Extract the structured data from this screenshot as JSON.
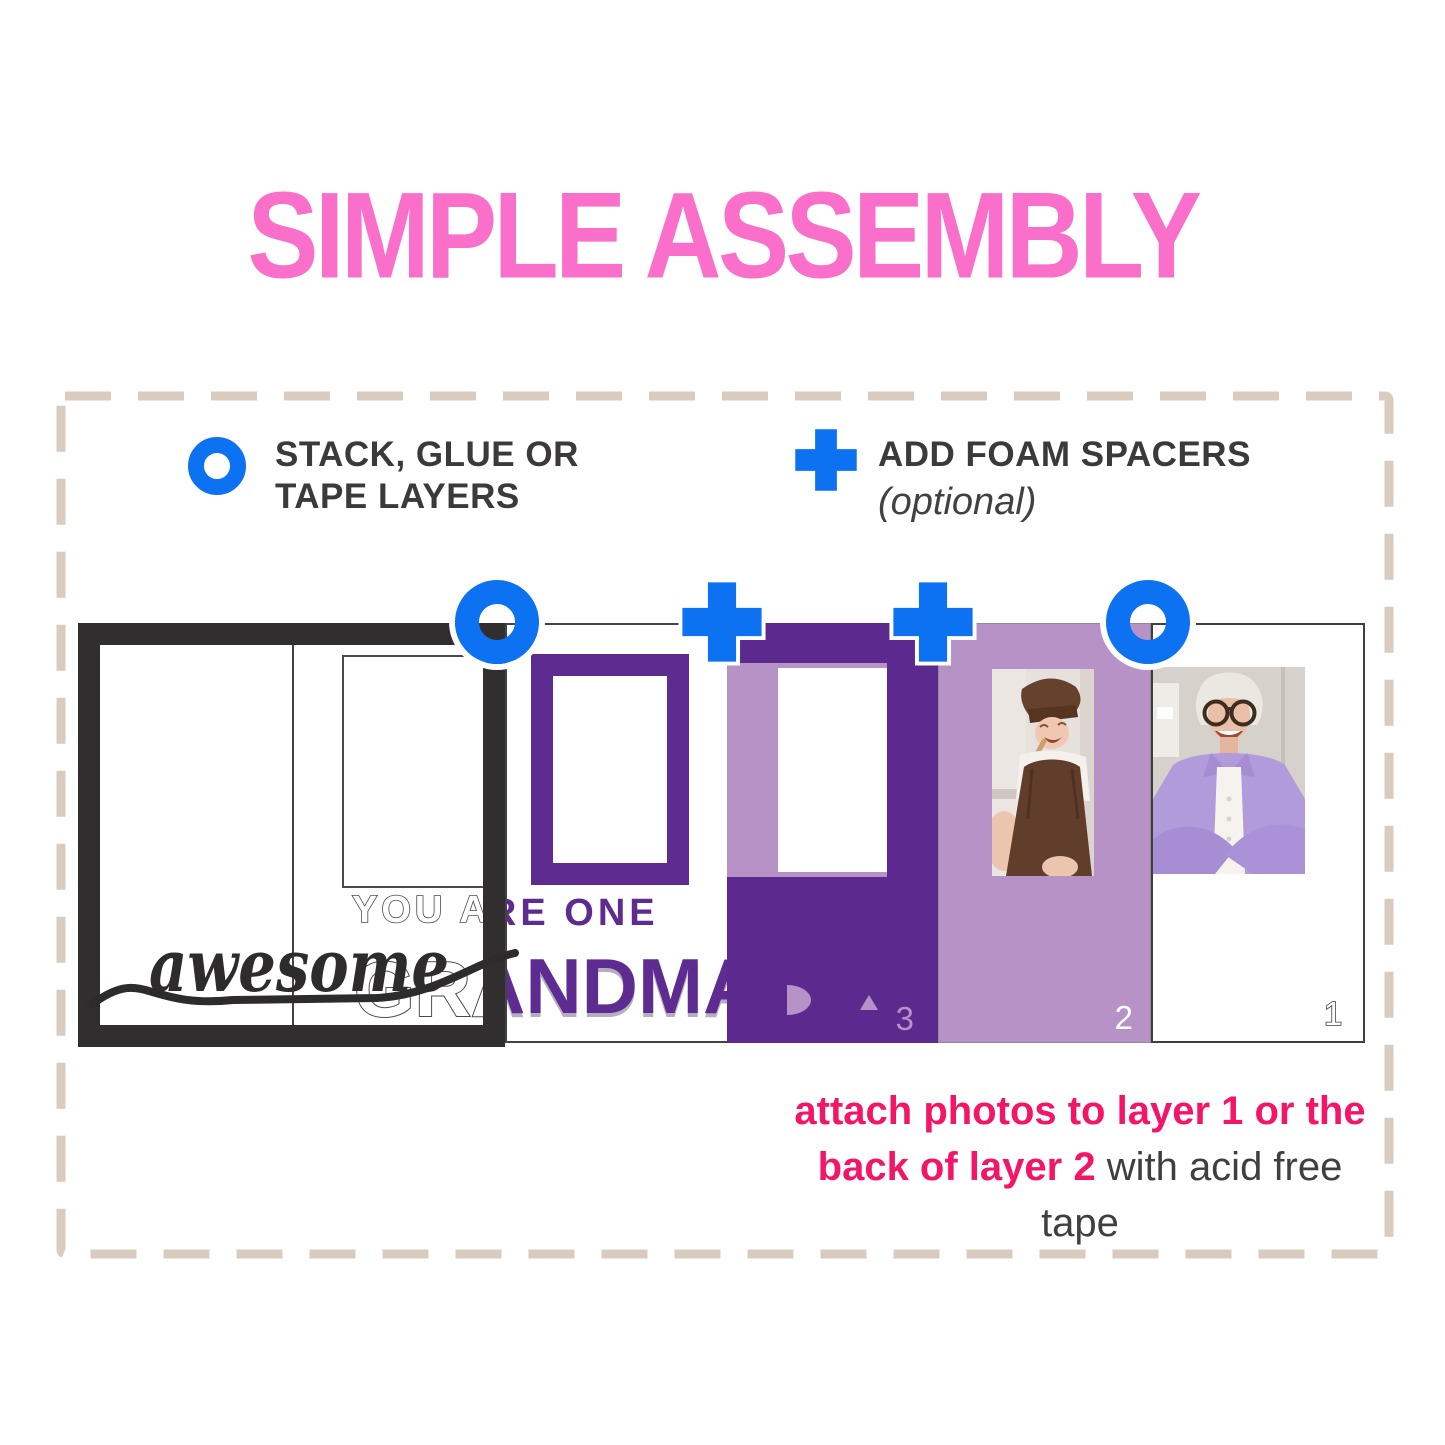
{
  "title": "SIMPLE ASSEMBLY",
  "legend": {
    "stack": {
      "icon": "ring-icon",
      "line1": "STACK, GLUE OR",
      "line2": "TAPE LAYERS"
    },
    "foam": {
      "icon": "plus-icon",
      "line1": "ADD FOAM SPACERS",
      "line2": "(optional)"
    }
  },
  "assembly_icons": [
    "ring",
    "plus",
    "plus",
    "ring"
  ],
  "design": {
    "script_word": "awesome",
    "tagline": "YOU ARE ONE",
    "name_word": "GRANDMA",
    "layer_numbers": {
      "layer3": "3",
      "layer2": "2",
      "layer1": "1"
    }
  },
  "photos": {
    "photo2": "child-in-brown-chef-hat-and-apron",
    "photo1": "grandma-with-glasses-in-lavender-shirt"
  },
  "caption": {
    "line1": "attach photos to layer 1 or the",
    "line2_bold": "back of layer 2",
    "line2_rest": " with acid free tape"
  },
  "colors": {
    "title_pink": "#fa6fc9",
    "caption_pink": "#f31568",
    "icon_blue": "#0d72f2",
    "purple": "#5e2b91",
    "lavender": "#b692c7",
    "frame_black": "#312e2f",
    "dash_beige": "#d9ccbf",
    "text_dark": "#3b3939"
  }
}
